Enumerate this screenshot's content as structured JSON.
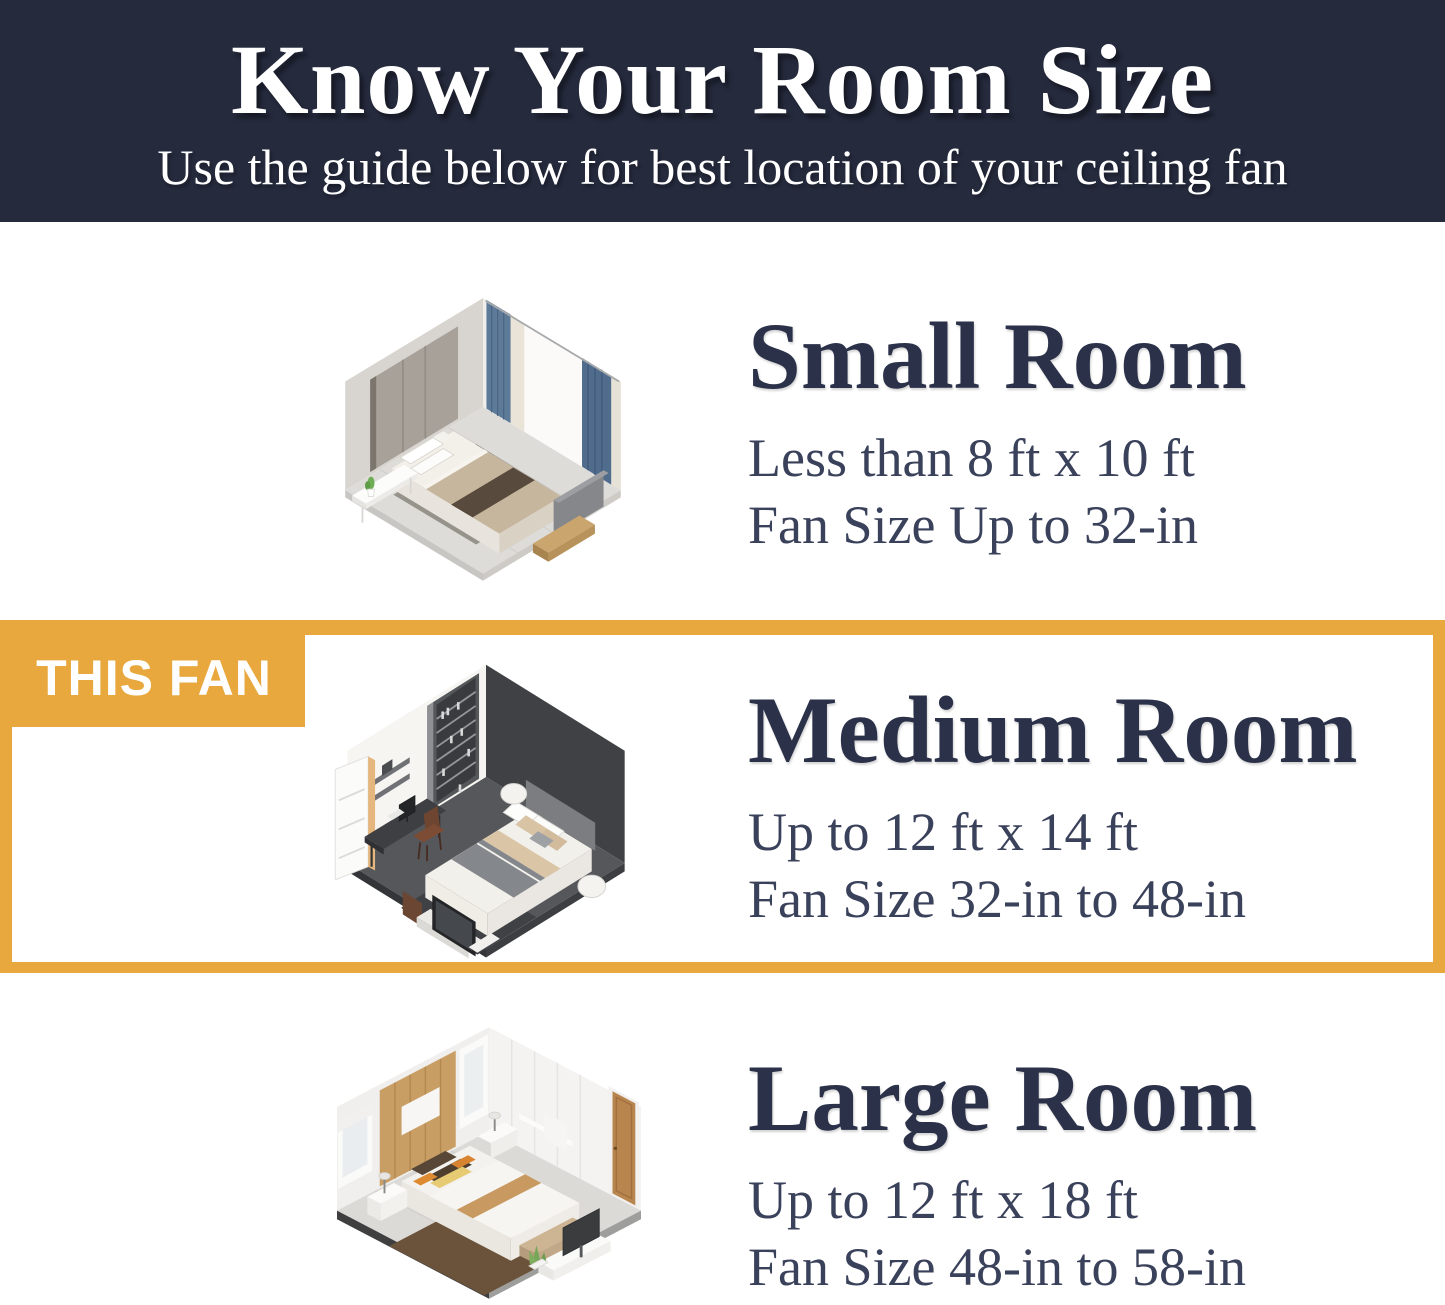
{
  "header": {
    "title": "Know Your Room Size",
    "subtitle": "Use the guide below for best location of your ceiling fan"
  },
  "sections": [
    {
      "name": "Small Room",
      "size_range": "Less than 8 ft x 10 ft",
      "fan_size": "Fan Size Up to 32-in",
      "highlighted": false,
      "illustration": "small-bedroom-isometric"
    },
    {
      "name": "Medium Room",
      "size_range": "Up to 12 ft x 14 ft",
      "fan_size": "Fan Size 32-in to 48-in",
      "highlighted": true,
      "badge": "THIS FAN",
      "illustration": "medium-bedroom-isometric"
    },
    {
      "name": "Large Room",
      "size_range": "Up to 12 ft x 18 ft",
      "fan_size": "Fan Size 48-in to 58-in",
      "highlighted": false,
      "illustration": "large-bedroom-isometric"
    }
  ],
  "theme": {
    "header_bg": "#252a3d",
    "accent_orange": "#e8a83e",
    "title_color": "#2a3149",
    "body_text_color": "#3a415a",
    "background": "#ffffff"
  }
}
